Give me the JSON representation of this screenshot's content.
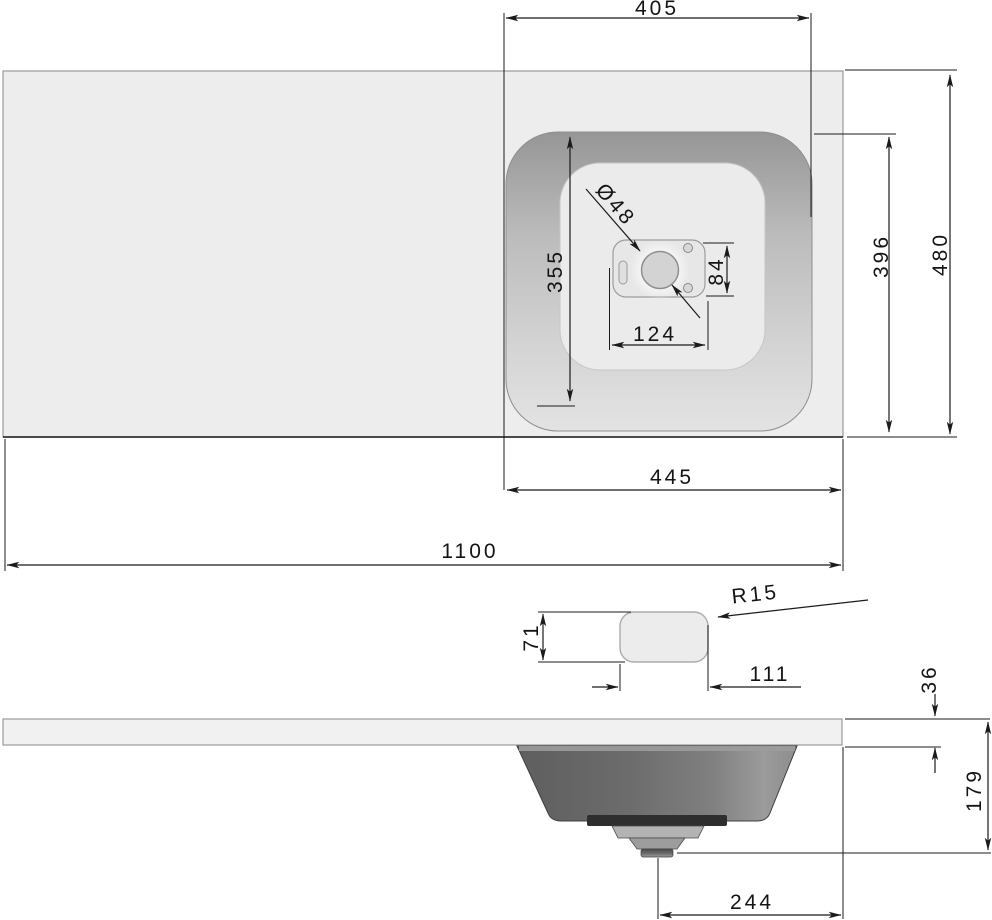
{
  "drawing_type": "washbasin-countertop-technical-drawing",
  "colors": {
    "background": "#ffffff",
    "line": "#1b1b1b",
    "worktop_surface": "#ededee",
    "basin_wall_dark": "#9a9a9a",
    "basin_wall_light": "#e2e2e2",
    "basin_floor": "#ebebeb",
    "bowl_dark": "#5e5e5e",
    "bowl_light": "#9b9b9b",
    "drain_band_dark": "#2e2e2e"
  },
  "dims": {
    "basin_cutout_width": "405",
    "worktop_depth": "480",
    "basin_cutout_depth": "396",
    "basin_inner_length": "355",
    "drain_hole_diameter": "Ø48",
    "drain_plate_height": "84",
    "drain_plate_width": "124",
    "basin_zone_width": "445",
    "worktop_width": "1100",
    "tap_hole_height": "71",
    "tap_hole_width": "111",
    "tap_hole_corner_radius": "R15",
    "worktop_thickness": "36",
    "overall_height": "179",
    "drain_center_to_edge": "244"
  }
}
